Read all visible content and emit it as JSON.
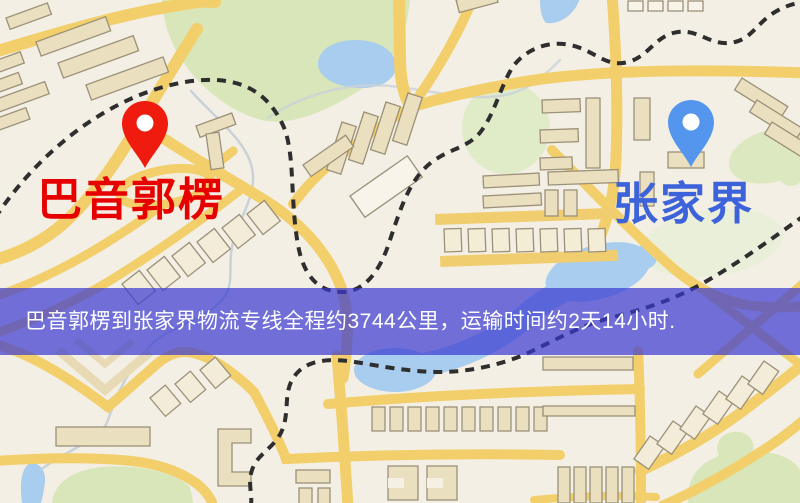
{
  "map": {
    "origin": {
      "name": "巴音郭楞",
      "marker": "red-pin",
      "marker_color": "#ee1b0e",
      "label_color": "#e60000"
    },
    "destination": {
      "name": "张家界",
      "marker": "blue-pin",
      "marker_color": "#5496ee",
      "label_color": "#3c63da"
    }
  },
  "banner": {
    "text": "巴音郭楞到张家界物流专线全程约3744公里，运输时间约2天14小时.",
    "distance": "约3744公里",
    "duration": "约2天14小时",
    "background_color": "#3939d1",
    "text_color": "#ffffff"
  },
  "map_colors": {
    "background": "#f3efe4",
    "road": "#f2cf6b",
    "building": "#eadfbf",
    "park_green": "#d8e6ba",
    "water": "#a9cdee",
    "railway": "#2e2e2e"
  }
}
